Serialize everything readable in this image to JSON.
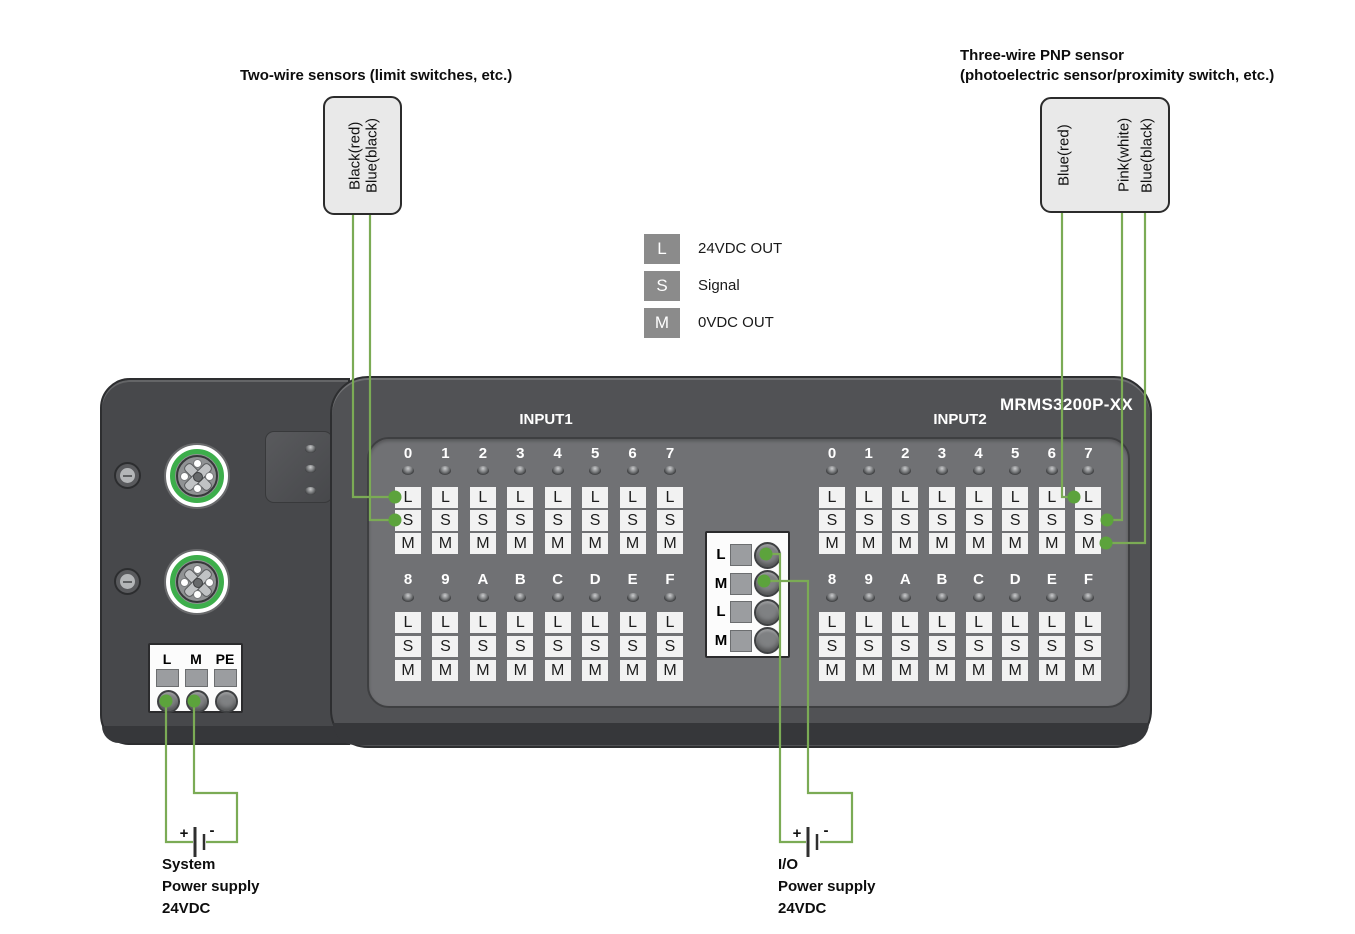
{
  "titles": {
    "two_wire": "Two-wire sensors (limit switches, etc.)",
    "three_wire_line1": "Three-wire PNP sensor",
    "three_wire_line2": "(photoelectric sensor/proximity switch, etc.)"
  },
  "sensors": {
    "two_wire_pins": [
      "Black(red)",
      "Blue(black)"
    ],
    "three_wire_pins": [
      "Blue(red)",
      "Pink(white)",
      "Blue(black)"
    ]
  },
  "legend": {
    "items": [
      {
        "key": "L",
        "label": "24VDC OUT"
      },
      {
        "key": "S",
        "label": "Signal"
      },
      {
        "key": "M",
        "label": "0VDC OUT"
      }
    ]
  },
  "device": {
    "model": "MRMS3200P-XX",
    "groups": [
      {
        "label": "INPUT1",
        "bank1": [
          "0",
          "1",
          "2",
          "3",
          "4",
          "5",
          "6",
          "7"
        ],
        "bank2": [
          "8",
          "9",
          "A",
          "B",
          "C",
          "D",
          "E",
          "F"
        ]
      },
      {
        "label": "INPUT2",
        "bank1": [
          "0",
          "1",
          "2",
          "3",
          "4",
          "5",
          "6",
          "7"
        ],
        "bank2": [
          "8",
          "9",
          "A",
          "B",
          "C",
          "D",
          "E",
          "F"
        ]
      }
    ],
    "cell_letters": [
      "L",
      "S",
      "M"
    ],
    "system_terminal": [
      "L",
      "M",
      "PE"
    ],
    "io_terminal": [
      "L",
      "M",
      "L",
      "M"
    ]
  },
  "supplies": {
    "plus": "+",
    "minus": "-",
    "system": {
      "lines": [
        "System",
        "Power supply",
        "24VDC"
      ]
    },
    "io": {
      "lines": [
        "I/O",
        "Power supply",
        "24VDC"
      ]
    }
  },
  "colors": {
    "wire_green": "#7bab55",
    "dot_green": "#5ca33c",
    "connector_ring_green": "#3dae4b",
    "legend_badge_gray": "#8b8b8b"
  }
}
